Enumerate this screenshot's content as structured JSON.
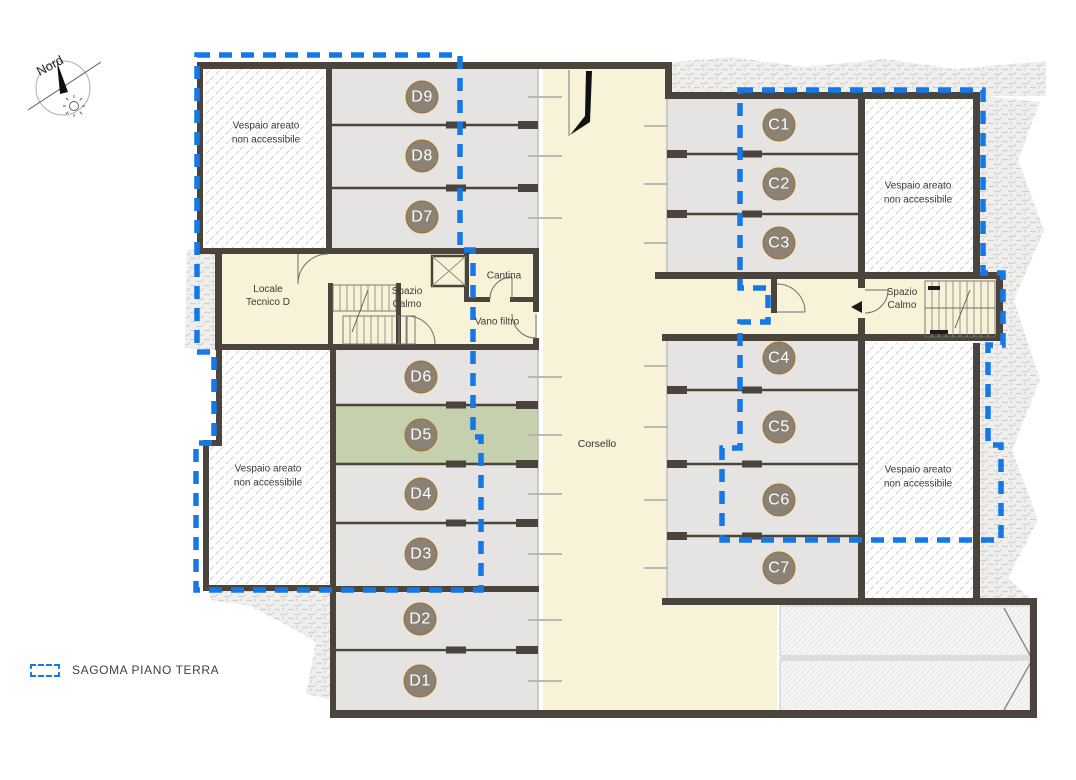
{
  "compass": {
    "label": "Nord"
  },
  "legend": {
    "label": "SAGOMA PIANO TERRA",
    "swatch_color": "#1478e8"
  },
  "plan": {
    "corridor_label": "Corsello",
    "rooms": {
      "locale_tecnico": {
        "line1": "Locale",
        "line2": "Tecnico D"
      },
      "spazio_calmo_left": {
        "line1": "Spazio",
        "line2": "Calmo"
      },
      "spazio_calmo_right": {
        "line1": "Spazio",
        "line2": "Calmo"
      },
      "cantina": {
        "label": "Cantina"
      },
      "vano_filtro": {
        "label": "Vano filtro"
      }
    },
    "vespaio_label": {
      "line1": "Vespaio areato",
      "line2": "non accessibile"
    },
    "vespaio_areas": [
      {
        "x": 266,
        "y": 133
      },
      {
        "x": 268,
        "y": 476
      },
      {
        "x": 918,
        "y": 193
      },
      {
        "x": 918,
        "y": 477
      }
    ],
    "highlighted_unit": "D5",
    "units": [
      {
        "label": "D9",
        "x": 422,
        "y": 97
      },
      {
        "label": "D8",
        "x": 422,
        "y": 156
      },
      {
        "label": "D7",
        "x": 422,
        "y": 217
      },
      {
        "label": "D6",
        "x": 421,
        "y": 377
      },
      {
        "label": "D5",
        "x": 421,
        "y": 435
      },
      {
        "label": "D4",
        "x": 421,
        "y": 494
      },
      {
        "label": "D3",
        "x": 421,
        "y": 554
      },
      {
        "label": "D2",
        "x": 420,
        "y": 619
      },
      {
        "label": "D1",
        "x": 420,
        "y": 681
      },
      {
        "label": "C1",
        "x": 779,
        "y": 125
      },
      {
        "label": "C2",
        "x": 779,
        "y": 184
      },
      {
        "label": "C3",
        "x": 779,
        "y": 243
      },
      {
        "label": "C4",
        "x": 779,
        "y": 358
      },
      {
        "label": "C5",
        "x": 779,
        "y": 427
      },
      {
        "label": "C6",
        "x": 779,
        "y": 500
      },
      {
        "label": "C7",
        "x": 779,
        "y": 568
      }
    ],
    "colors": {
      "sagoma": "#1478e8",
      "badge_fill": "#8b8174",
      "badge_rim": "#a4701f",
      "highlight_room": "#c5d1ae",
      "driveway": "#f8f2d8",
      "room": "#e6e4e2",
      "wall": "#4a443c"
    }
  }
}
